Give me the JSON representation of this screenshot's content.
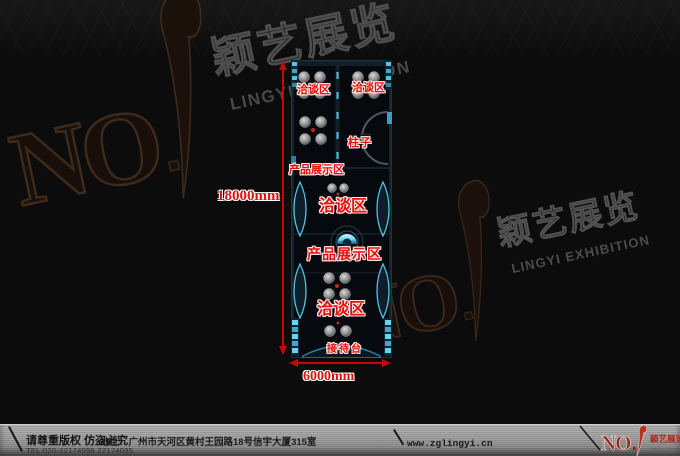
{
  "watermark": {
    "no_text": "NO",
    "brand_cn": "颖艺展览",
    "brand_en": "LINGYI EXHIBITION"
  },
  "plan": {
    "areas": {
      "meeting_top_left": "洽谈区",
      "meeting_top_right": "洽谈区",
      "pillar": "柱子",
      "display_upper": "产品展示区",
      "meeting_middle": "洽谈区",
      "display_main": "产品展示区",
      "meeting_lower": "洽谈区",
      "reception": "接待台"
    },
    "dimensions": {
      "height": "18000mm",
      "width": "6000mm"
    }
  },
  "footer": {
    "copyright": "请尊重版权 仿盗必究",
    "tel": "TEL:020-22174096 22174095",
    "address": "地址：广州市天河区黄村王园路18号信宇大厦315室",
    "website": "www.zglingyi.cn",
    "logo": {
      "no_text": "NO",
      "brand_cn": "颖艺展览",
      "brand_en": "LINGYI EXHIBITION"
    }
  },
  "colors": {
    "label_red": "#e8100c",
    "dimension_red": "#c40808",
    "plan_cyan": "#55c4e6",
    "footer_logo_red": "#9c2418"
  }
}
